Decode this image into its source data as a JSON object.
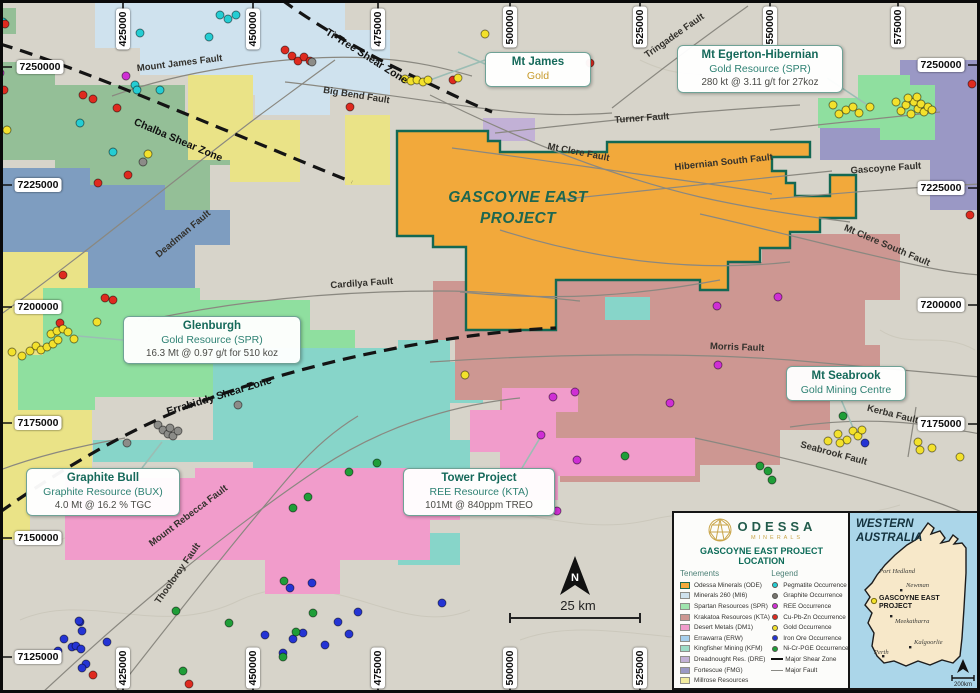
{
  "map": {
    "project": {
      "name_line1": "GASCOYNE EAST",
      "name_line2": "PROJECT"
    },
    "coords": {
      "top": [
        "425000",
        "450000",
        "475000",
        "500000",
        "525000",
        "550000",
        "575000"
      ],
      "bottom": [
        "425000",
        "450000",
        "475000",
        "500000",
        "525000"
      ],
      "left": [
        "7250000",
        "7225000",
        "7200000",
        "7175000",
        "7150000",
        "7125000"
      ],
      "right": [
        "7250000",
        "7225000",
        "7200000",
        "7175000"
      ]
    },
    "faults": {
      "mount_james": "Mount James Fault",
      "ti_tree": "Ti-Tree Shear Zone",
      "big_bend": "Big Bend Fault",
      "chalba": "Chalba Shear Zone",
      "deadman": "Deadman Fault",
      "cardilya": "Cardilya Fault",
      "errabiddy": "Errabiddy Shear Zone",
      "mount_rebecca": "Mount Rebecca Fault",
      "thooloroy": "Thooloroy Fault",
      "tringadee": "Tringadee Fault",
      "turner": "Turner Fault",
      "mt_clere": "Mt Clere Fault",
      "hibernian_south": "Hibernian South Fault",
      "gascoyne": "Gascoyne Fault",
      "mt_clere_south": "Mt Clere South Fault",
      "morris": "Morris Fault",
      "kerba": "Kerba Fault",
      "seabrook": "Seabrook Fault"
    },
    "scale_label": "25 km",
    "north_label": "N"
  },
  "callouts": {
    "mt_james": {
      "title": "Mt James",
      "line2": "Gold"
    },
    "egerton": {
      "title": "Mt Egerton-Hibernian",
      "line2": "Gold Resource (SPR)",
      "line3": "280 kt @ 3.11 g/t for 27koz"
    },
    "glenburgh": {
      "title": "Glenburgh",
      "line2": "Gold Resource (SPR)",
      "line3": "16.3 Mt @ 0.97 g/t for 510 koz"
    },
    "graphite_bull": {
      "title": "Graphite Bull",
      "line2": "Graphite Resource (BUX)",
      "line3": "4.0 Mt @ 16.2 % TGC"
    },
    "tower": {
      "title": "Tower Project",
      "line2": "REE Resource (KTA)",
      "line3": "101Mt @ 840ppm TREO"
    },
    "seabrook": {
      "title": "Mt Seabrook",
      "line2": "Gold Mining Centre"
    }
  },
  "legend_panel": {
    "logo_text": "ODESSA",
    "logo_sub": "MINERALS",
    "title": "GASCOYNE EAST PROJECT LOCATION",
    "tenements_header": "Tenements",
    "legend_header": "Legend",
    "tenements": [
      {
        "label": "Odessa Minerals (ODE)",
        "color": "#f2a93b"
      },
      {
        "label": "Minerals 260 (MI6)",
        "color": "#cfe2ee"
      },
      {
        "label": "Spartan Resources (SPR)",
        "color": "#9fe5ae"
      },
      {
        "label": "Krakatoa Resources (KTA)",
        "color": "#cd9792"
      },
      {
        "label": "Desert Metals (DM1)",
        "color": "#f19ccb"
      },
      {
        "label": "Errawarra (ERW)",
        "color": "#a6cfec"
      },
      {
        "label": "Kingfisher Mining (KFM)",
        "color": "#9ddcc6"
      },
      {
        "label": "Dreadnought Res. (DRE)",
        "color": "#c2b1d6"
      },
      {
        "label": "Fortescue (FMG)",
        "color": "#9a98c5"
      },
      {
        "label": "Millrose Resources",
        "color": "#f2eb9e"
      }
    ],
    "occurrences": [
      {
        "label": "Pegmatite Occurrence",
        "color": "#25cdd3"
      },
      {
        "label": "Graphite Occurrence",
        "color": "#77756f"
      },
      {
        "label": "REE Occurrence",
        "color": "#cf2fd4"
      },
      {
        "label": "Cu-Pb-Zn Occurrence",
        "color": "#df2a1f"
      },
      {
        "label": "Gold Occurrence",
        "color": "#f3e12c"
      },
      {
        "label": "Iron Ore Occurrence",
        "color": "#2434d4"
      },
      {
        "label": "Ni-Cr-PGE Occurrence",
        "color": "#1f9e38"
      }
    ],
    "line_items": [
      {
        "label": "Major Shear Zone"
      },
      {
        "label": "Major Fault"
      }
    ]
  },
  "inset": {
    "title_line1": "WESTERN",
    "title_line2": "AUSTRALIA",
    "cities": [
      "Port Hedland",
      "Newman",
      "Meekatharra",
      "Kalgoorlie",
      "Perth"
    ],
    "project_line1": "GASCOYNE EAST",
    "project_line2": "PROJECT",
    "scale_label": "200km"
  }
}
